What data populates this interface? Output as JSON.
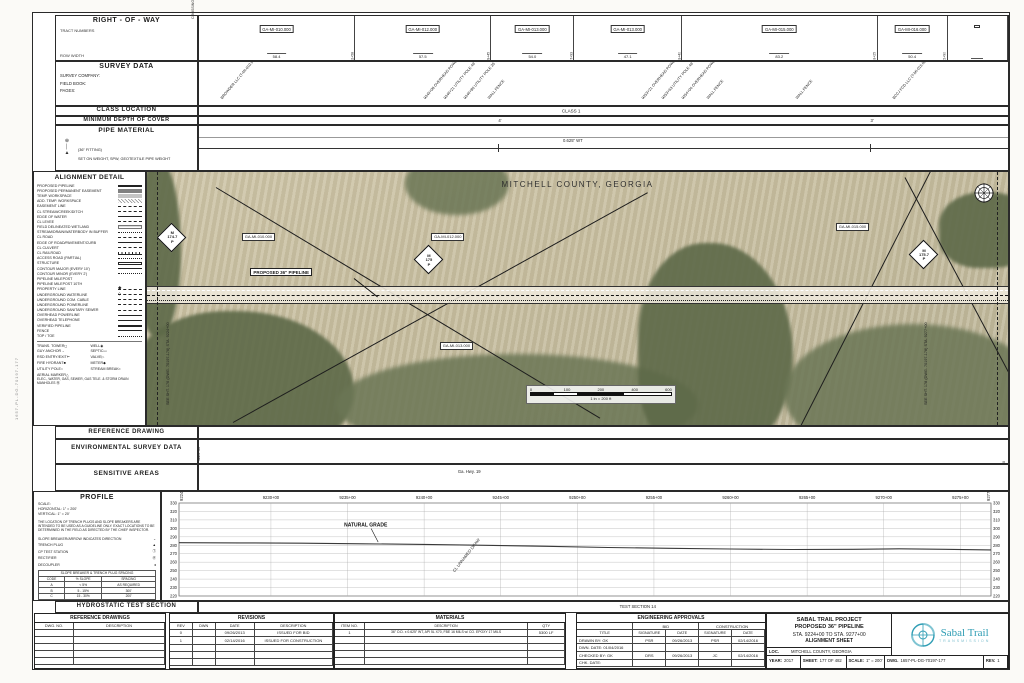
{
  "sheet": {
    "side_text": "1657-PL-DG-70197-177",
    "teal": "#2f9db4"
  },
  "row_section": {
    "title": "RIGHT - OF - WAY",
    "tract_numbers_label": "TRACT NUMBERS",
    "row_width_label": "ROW WIDTH",
    "crossing_label": "CROSSING",
    "tracts": [
      {
        "label": "GA-MI-010.000",
        "width": "58.4",
        "grow": 157,
        "sta": "9232+58"
      },
      {
        "label": "GA-MI-012.000",
        "width": "57.5",
        "grow": 137,
        "sta": "9239+45"
      },
      {
        "label": "GA-MI-013.000",
        "width": "54.0",
        "grow": 83,
        "sta": "9247+93"
      },
      {
        "label": "GA-MI-013.000",
        "width": "47.1",
        "grow": 108,
        "sta": "9253+40"
      },
      {
        "label": "GA-MI-015.000",
        "width": "83.2",
        "grow": 197,
        "sta": "9263+25"
      },
      {
        "label": "GA-MI-016.000",
        "width": "50.4",
        "grow": 70,
        "sta": "9272+90"
      },
      {
        "label": "",
        "width": "",
        "grow": 60,
        "sta": ""
      }
    ]
  },
  "survey_section": {
    "title": "SURVEY DATA",
    "fields": [
      "SURVEY COMPANY:",
      "FIELD BOOK:",
      "PAGES:"
    ],
    "crossings": [
      {
        "x": 3,
        "text": "BROWDER LLC (T-MI-010.000)"
      },
      {
        "x": 28,
        "text": "9245+08 OVERHEAD POWERLINE"
      },
      {
        "x": 30.5,
        "text": "9246+21 UTILITY POLE 49' LT"
      },
      {
        "x": 33,
        "text": "9246+80 UTILITY POLE 35' LT"
      },
      {
        "x": 36,
        "text": "WALL FENCE"
      },
      {
        "x": 55,
        "text": "9253+21 OVERHEAD POWERLINE"
      },
      {
        "x": 57.5,
        "text": "9253+63 UTILITY POLE 49' LT"
      },
      {
        "x": 60,
        "text": "9254+04 OVERHEAD POWERLINE"
      },
      {
        "x": 63,
        "text": "WALL FENCE"
      },
      {
        "x": 74,
        "text": "WALL FENCE"
      },
      {
        "x": 86,
        "text": "BCCJ FCD LLC (T-MI-015.000)"
      }
    ]
  },
  "class_section": {
    "title": "CLASS LOCATION",
    "value": "CLASS 1"
  },
  "depth_section": {
    "title": "MINIMUM DEPTH OF COVER",
    "values": [
      {
        "x": 37,
        "text": "4'"
      },
      {
        "x": 83,
        "text": "3'"
      }
    ]
  },
  "pipe_section": {
    "title": "PIPE MATERIAL",
    "note1": "(36\" FITTING)",
    "note2": "SET ON WEIGHT, SPW, GEOTEXTILE PIPE WEIGHT",
    "value": "0.625\" WT"
  },
  "legend": {
    "title": "ALIGNMENT DETAIL",
    "items": [
      {
        "label": "PROPOSED PIPELINE",
        "style": "thick"
      },
      {
        "label": "PROPOSED PERMANENT EASEMENT",
        "style": "band"
      },
      {
        "label": "TEMP. WORKSPACE",
        "style": "band2"
      },
      {
        "label": "ADD. TEMP. WORKSPACE",
        "style": "hatch"
      },
      {
        "label": "EASEMENT LINE",
        "style": "dashdot"
      },
      {
        "label": "CL STREAM/CREEK/DITCH",
        "style": "dash"
      },
      {
        "label": "EDGE OF WATER",
        "style": "thin"
      },
      {
        "label": "CL LEVEE",
        "style": "dashdotdot"
      },
      {
        "label": "FIELD DELINEATED WETLAND",
        "style": "wet"
      },
      {
        "label": "STREAM/DRAIN/WATERBODY IN BUFFER",
        "style": "dot"
      },
      {
        "label": "CL ROAD",
        "style": "dashdot"
      },
      {
        "label": "EDGE OF ROAD/PAVEMENT/CURB",
        "style": "thin"
      },
      {
        "label": "CL CULVERT",
        "style": "dash"
      },
      {
        "label": "CL RAILROAD",
        "style": "rail"
      },
      {
        "label": "ACCESS ROAD (PARTIAL)",
        "style": "dot"
      },
      {
        "label": "STRUCTURE",
        "style": "struct"
      },
      {
        "label": "CONTOUR MAJOR (EVERY 10')",
        "style": "thin"
      },
      {
        "label": "CONTOUR MINOR (EVERY 2')",
        "style": "dot"
      },
      {
        "label": "PIPELINE MILEPOST",
        "style": "mp"
      },
      {
        "label": "PIPELINE MILEPOST 10TH",
        "style": "mp10"
      },
      {
        "label": "PROPERTY LINE",
        "style": "dashdot"
      },
      {
        "label": "UNDERGROUND WATERLINE",
        "style": "dash"
      },
      {
        "label": "UNDERGROUND COM. CABLE",
        "style": "dash"
      },
      {
        "label": "UNDERGROUND POWERLINE",
        "style": "dash"
      },
      {
        "label": "UNDERGROUND SANITARY SEWER",
        "style": "dash"
      },
      {
        "label": "OVERHEAD POWERLINE",
        "style": "thin"
      },
      {
        "label": "OVERHEAD TELEPHONE",
        "style": "thin"
      },
      {
        "label": "VERIFIED PIPELINE",
        "style": "thick"
      },
      {
        "label": "FENCE",
        "style": "fence"
      },
      {
        "label": "TOP / TOE",
        "style": "dot"
      }
    ],
    "symbols_left": [
      {
        "label": "TRANS. TOWER",
        "glyph": "◻"
      },
      {
        "label": "GUY ANCHOR",
        "glyph": "→"
      },
      {
        "label": "RSD ENTRY/EXIT",
        "glyph": "⊢"
      },
      {
        "label": "FIRE HYDRANT",
        "glyph": "■"
      },
      {
        "label": "UTILITY POLE",
        "glyph": "○"
      },
      {
        "label": "AERIAL MARKER",
        "glyph": "△"
      }
    ],
    "symbols_right": [
      {
        "label": "WELL",
        "glyph": "◉"
      },
      {
        "label": "SEPTIC",
        "glyph": "▭"
      },
      {
        "label": "VALVE",
        "glyph": "▷"
      },
      {
        "label": "METER",
        "glyph": "◆"
      },
      {
        "label": "STREAM BREAK",
        "glyph": "≈"
      }
    ],
    "note": "ELEC., WATER, GAS, SEWER, GAS TELE. & STORM DRAIN MANHOLES",
    "note_glyph": "Ⓜ"
  },
  "map": {
    "county_title": "MITCHELL COUNTY, GEORGIA",
    "pipeline_label": "PROPOSED 36\" PIPELINE",
    "mp_letter_top": "M",
    "mp_letter_bottom": "P",
    "mileposts": [
      {
        "x": 1.2,
        "y": 20,
        "num": "174.7"
      },
      {
        "x": 31,
        "y": 29,
        "num": "175"
      },
      {
        "x": 88.5,
        "y": 27,
        "num": "175.7"
      }
    ],
    "tract_labels": [
      {
        "x": 11,
        "y": 24,
        "text": "GA-MI-010.000"
      },
      {
        "x": 33,
        "y": 24,
        "text": "GA-MI-012.000"
      },
      {
        "x": 80,
        "y": 20,
        "text": "GA-MI-015.000"
      },
      {
        "x": 34,
        "y": 67,
        "text": "GA-MI-013.000"
      }
    ],
    "matchline_left": "SEE SHT. 176 (DWG. 70197-176)  STA. 9224+00",
    "matchline_right": "SEE SHT. 178 (DWG. 70197-178)  STA. 9277+00",
    "scalebar": {
      "ticks": [
        "0",
        "100",
        "200",
        "400",
        "600"
      ],
      "caption": "1 in = 200 ft"
    }
  },
  "ref_section": {
    "title": "REFERENCE DRAWING"
  },
  "env_section": {
    "title": "ENVIRONMENTAL SURVEY DATA",
    "sta_left": "9224+00",
    "sta_right": "9277+00"
  },
  "sens_section": {
    "title": "SENSITIVE AREAS",
    "value": "Ga. Hwy. 19"
  },
  "profile_section": {
    "title": "PROFILE",
    "scale_label": "SCALE:",
    "h_scale": "HORIZONTAL: 1\" = 200'",
    "v_scale": "VERTICAL: 1\" = 20'",
    "note": "THE LOCATION OF TRENCH PLUGS AND SLOPE BREAKERS ARE INTENDED TO BE USED AS A GUIDELINE ONLY. EXACT LOCATIONS TO BE DETERMINED IN THE FIELD AS DIRECTED BY THE CHIEF INSPECTOR.",
    "legend": [
      {
        "label": "SLOPE BREAKER/ARROW INDICATES DIRECTION",
        "glyph": "⌄"
      },
      {
        "label": "TRENCH PLUG",
        "glyph": "▲"
      },
      {
        "label": "CP TEST STATION",
        "glyph": "Ⓣ"
      },
      {
        "label": "RECTIFIER",
        "glyph": "Ⓡ"
      },
      {
        "label": "DECOUPLER",
        "glyph": "♦"
      }
    ],
    "spacing_table": {
      "title": "SLOPE BREAKER & TRENCH PLUG SPACING",
      "cols": [
        "CODE",
        "% SLOPE",
        "SPACING"
      ],
      "rows": [
        [
          "A",
          "< 5%",
          "AS REQUIRED"
        ],
        [
          "B",
          "5 - 15%",
          "300'"
        ],
        [
          "C",
          "15 - 30%",
          "200'"
        ],
        [
          "D",
          "> 30%",
          "100'"
        ]
      ]
    }
  },
  "hydro_section": {
    "title": "HYDROSTATIC TEST SECTION",
    "value": "TEST SECTION 14"
  },
  "chart_data": {
    "type": "line",
    "title": "PROFILE — NATURAL GRADE",
    "xlabel": "STATION",
    "ylabel": "ELEVATION (FT)",
    "xlim": [
      9224,
      9277
    ],
    "ylim": [
      220,
      330
    ],
    "grid": true,
    "legend_position": "none",
    "x_tick_stations": [
      9230,
      9235,
      9240,
      9245,
      9250,
      9255,
      9260,
      9265,
      9270,
      9275
    ],
    "x_tick_labels": [
      "9230+00",
      "9235+00",
      "9240+00",
      "9245+00",
      "9250+00",
      "9255+00",
      "9260+00",
      "9265+00",
      "9270+00",
      "9275+00"
    ],
    "x_edge_labels": [
      "9224+00",
      "9277+00"
    ],
    "y_ticks": [
      330,
      320,
      310,
      300,
      290,
      280,
      270,
      260,
      250,
      240,
      230,
      220
    ],
    "series": [
      {
        "name": "NATURAL GRADE",
        "x": [
          9224,
          9228,
          9232,
          9236,
          9240,
          9244,
          9248,
          9252,
          9256,
          9260,
          9264,
          9268,
          9271,
          9274,
          9277
        ],
        "elev": [
          283,
          282.8,
          282.4,
          281.8,
          281,
          280,
          278.8,
          277.4,
          276.4,
          275.6,
          275,
          275.2,
          275.8,
          275.2,
          274.5
        ]
      }
    ],
    "annotations": [
      {
        "station": 9237,
        "elev": 282,
        "text": "NATURAL GRADE"
      },
      {
        "station": 9242,
        "elev": 248,
        "text": "CL UNNAMED DRAW",
        "rotate": -52
      }
    ]
  },
  "bottom": {
    "ref_drawings": {
      "title": "REFERENCE DRAWINGS",
      "cols": [
        "DWG. NO.",
        "DESCRIPTION"
      ],
      "rows": [
        [
          "",
          ""
        ],
        [
          "",
          ""
        ],
        [
          "",
          ""
        ],
        [
          "",
          ""
        ],
        [
          "",
          ""
        ]
      ]
    },
    "revisions": {
      "title": "REVISIONS",
      "cols": [
        "REV",
        "DWN",
        "DATE",
        "DESCRIPTION"
      ],
      "rows": [
        [
          "0",
          "",
          "09/26/2013",
          "ISSUED FOR BID"
        ],
        [
          "1",
          "",
          "02/14/2016",
          "ISSUED FOR CONSTRUCTION"
        ],
        [
          "",
          "",
          "",
          ""
        ],
        [
          "",
          "",
          "",
          ""
        ],
        [
          "",
          "",
          "",
          ""
        ]
      ]
    },
    "materials": {
      "title": "MATERIALS",
      "cols": [
        "ITEM NO.",
        "DESCRIPTION",
        "QTY"
      ],
      "rows": [
        [
          "1",
          "36\" O.D. x 0.625\" WT, API 5L X70, FBE 16 MILS w/ CO. EPOXY 17 MILS",
          "5300 LF"
        ],
        [
          "",
          "",
          ""
        ],
        [
          "",
          "",
          ""
        ],
        [
          "",
          "",
          ""
        ],
        [
          "",
          "",
          ""
        ]
      ]
    },
    "approvals": {
      "title": "ENGINEERING APPROVALS",
      "bid": "BID",
      "construction": "CONSTRUCTION",
      "cols": [
        "TITLE",
        "SIGNATURE",
        "DATE",
        "SIGNATURE",
        "DATE"
      ],
      "rows": [
        [
          "DRAWN BY:  GK",
          "PSR",
          "09/26/2013",
          "PSR",
          "02/14/2016"
        ],
        [
          "DWN. DATE:  01/04/2016",
          "",
          "",
          "",
          ""
        ],
        [
          "CHECKED BY:  GK",
          "DRS",
          "09/26/2013",
          "JC",
          "02/14/2016"
        ],
        [
          "CHK. DATE:",
          "",
          "",
          "",
          ""
        ]
      ]
    }
  },
  "title_block": {
    "line1": "SABAL TRAIL PROJECT",
    "line2": "PROPOSED 36\" PIPELINE",
    "line3": "STA. 9224+00 TO STA. 9277+00",
    "line4": "ALIGNMENT SHEET",
    "loc_label": "LOC.",
    "loc": "MITCHELL COUNTY, GEORGIA",
    "year_label": "YEAR:",
    "year": "2017",
    "sheet_label": "SHEET:",
    "sheet": "177 OF 482",
    "scale_label": "SCALE:",
    "scale": "1\" = 200'",
    "dwg_label": "DWG.",
    "dwg": "1657-PL-DG-70197-177",
    "rev_label": "REV.",
    "rev": "1",
    "logo_name": "Sabal Trail",
    "logo_sub": "TRANSMISSION"
  }
}
